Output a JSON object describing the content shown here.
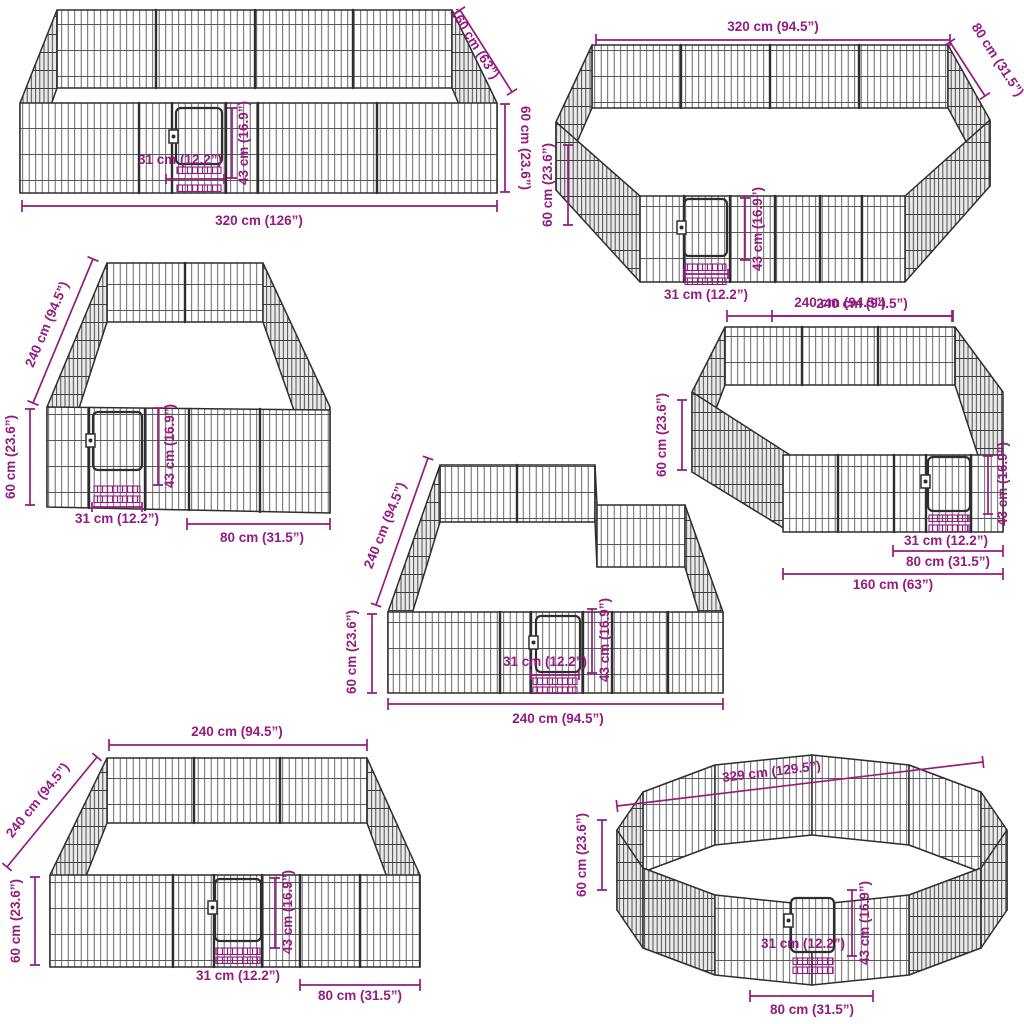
{
  "colors": {
    "dimension_accent": "#951b81",
    "fence_outline": "#2e2e2e"
  },
  "configs": {
    "c1": {
      "depth": "160 cm (63”)",
      "height": "60 cm (23.6”)",
      "gate_height": "43 cm (16.9”)",
      "gate_width": "31 cm (12.2”)",
      "width": "320 cm (126”)"
    },
    "c2": {
      "width_top": "320 cm (94.5”)",
      "side": "80 cm (31.5”)",
      "height": "60 cm (23.6”)",
      "gate_height": "43 cm (16.9”)",
      "gate_width": "31 cm (12.2”)",
      "width_bottom": "240 cm (94.5”)"
    },
    "c3": {
      "depth": "240 cm (94.5”)",
      "height": "60 cm (23.6”)",
      "gate_height": "43 cm (16.9”)",
      "gate_width": "31 cm (12.2”)",
      "panel": "80 cm (31.5”)"
    },
    "c4": {
      "width_top": "240 cm (94.5”)",
      "height": "60 cm (23.6”)",
      "gate_height": "43 cm (16.9”)",
      "gate_width": "31 cm (12.2”)",
      "panel": "80 cm (31.5”)",
      "width_bottom": "160 cm (63”)"
    },
    "c5": {
      "depth": "240 cm (94.5”)",
      "height": "60 cm (23.6”)",
      "gate_width": "31 cm (12.2”)",
      "gate_height": "43 cm (16.9”)",
      "width_bottom": "240 cm (94.5”)"
    },
    "c6": {
      "width_top": "240 cm (94.5”)",
      "depth": "240 cm (94.5”)",
      "height": "60 cm (23.6”)",
      "gate_width": "31 cm (12.2”)",
      "gate_height": "43 cm (16.9”)",
      "panel": "80 cm (31.5”)"
    },
    "c7": {
      "diameter": "329 cm (129.5”)",
      "height": "60 cm (23.6”)",
      "gate_width": "31 cm (12.2”)",
      "gate_height": "43 cm (16.9”)",
      "panel": "80 cm (31.5”)"
    }
  }
}
